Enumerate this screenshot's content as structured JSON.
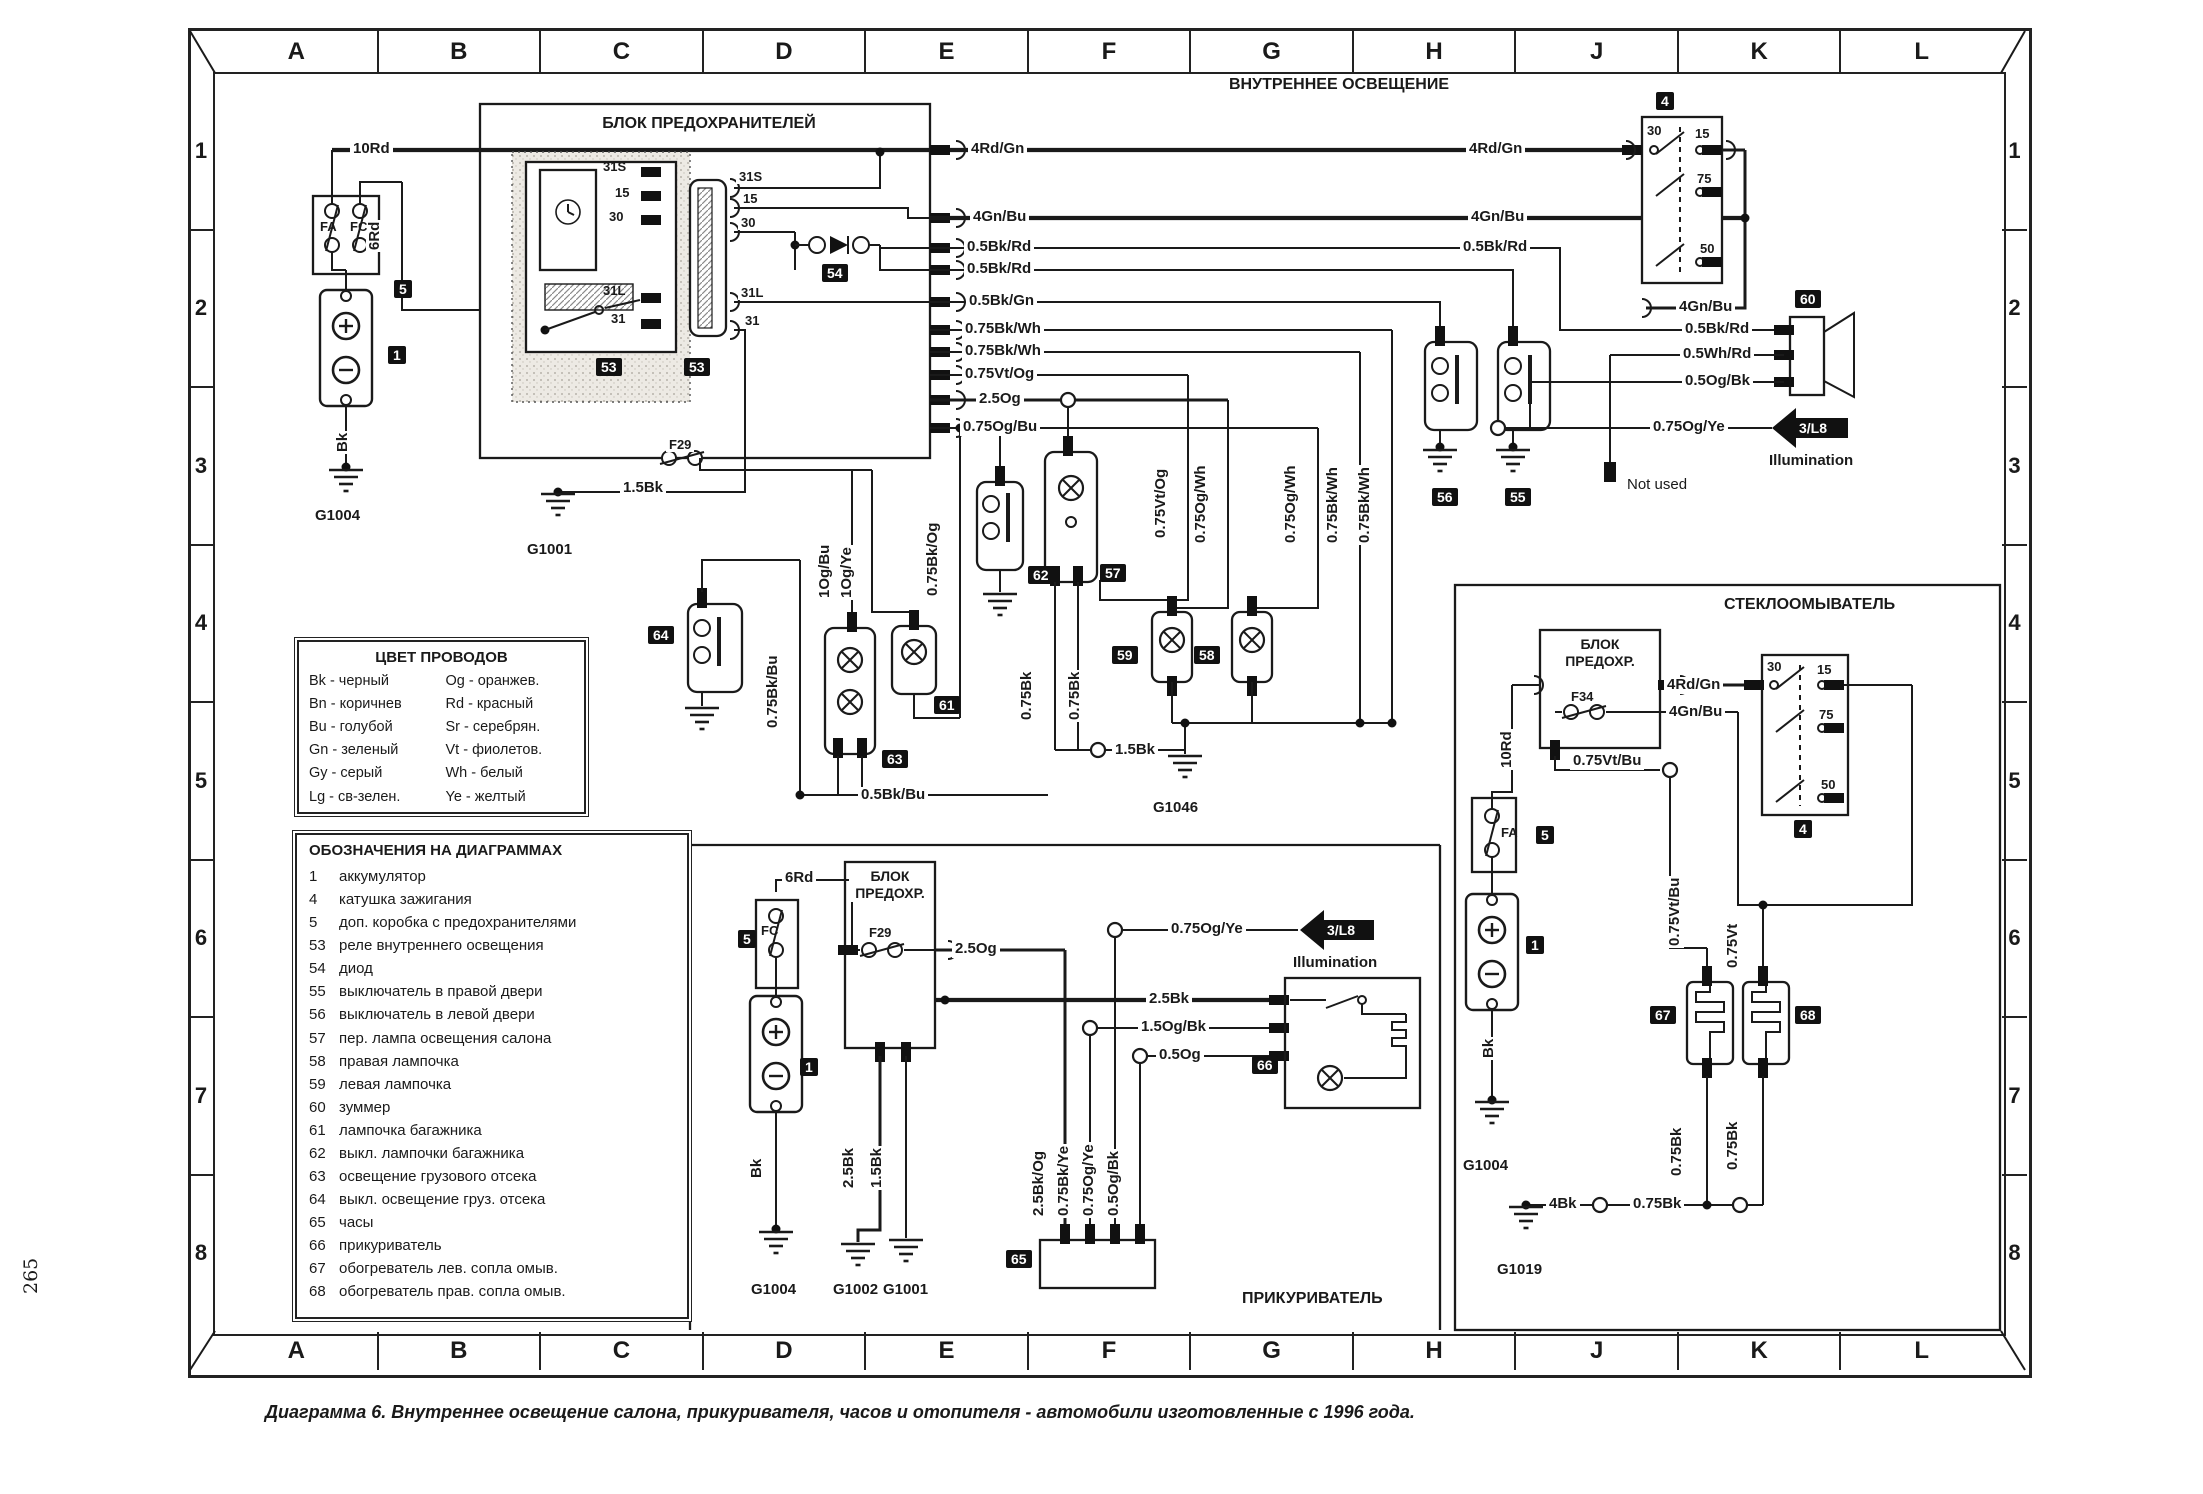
{
  "page": {
    "number": "265",
    "caption": "Диаграмма 6. Внутреннее освещение салона, прикуривателя, часов и отопителя - автомобили изготовленные с 1996 года."
  },
  "grid": {
    "columns": [
      "A",
      "B",
      "C",
      "D",
      "E",
      "F",
      "G",
      "H",
      "J",
      "K",
      "L"
    ],
    "rows": [
      "1",
      "2",
      "3",
      "4",
      "5",
      "6",
      "7",
      "8"
    ]
  },
  "ti": {
    "interior": "ВНУТРЕННЕЕ ОСВЕЩЕНИЕ",
    "washer": "СТЕКЛООМЫВАТЕЛЬ",
    "lighter": "ПРИКУРИВАТЕЛЬ",
    "fuse_main": "БЛОК ПРЕДОХРАНИТЕЛЕЙ",
    "fuse_s1": "БЛОК",
    "fuse_s2": "ПРЕДОХР."
  },
  "w": {
    "w10Rd": "10Rd",
    "w6Rd": "6Rd",
    "wBk": "Bk",
    "w15Bk": "1.5Bk",
    "w25Bk": "2.5Bk",
    "w4Bk": "4Bk",
    "w075Bk": "0.75Bk",
    "w4RdGn": "4Rd/Gn",
    "w4GnBu": "4Gn/Bu",
    "w05BkRd": "0.5Bk/Rd",
    "w05WhRd": "0.5Wh/Rd",
    "w05OgBk": "0.5Og/Bk",
    "w05BkGn": "0.5Bk/Gn",
    "w05Og": "0.5Og",
    "w05BkBu": "0.5Bk/Bu",
    "w075BkWh": "0.75Bk/Wh",
    "w075VtOg": "0.75Vt/Og",
    "w075OgBu": "0.75Og/Bu",
    "w075OgYe": "0.75Og/Ye",
    "w075OgWh": "0.75Og/Wh",
    "w075BkOg": "0.75Bk/Og",
    "w075BkBu": "0.75Bk/Bu",
    "w075BkYe": "0.75Bk/Ye",
    "w075VtBu": "0.75Vt/Bu",
    "w075Vt": "0.75Vt",
    "w1OgBu": "1Og/Bu",
    "w1OgYe": "1Og/Ye",
    "w25Og": "2.5Og",
    "w25BkOg": "2.5Bk/Og",
    "w15OgBk": "1.5Og/Bk"
  },
  "t": {
    "t30": "30",
    "t15": "15",
    "t75": "75",
    "t50": "50",
    "t31S": "31S",
    "t31L": "31L",
    "t31": "31"
  },
  "f": {
    "F29": "F29",
    "F34": "F34",
    "FA": "FA",
    "FC": "FC"
  },
  "g": {
    "G1001": "G1001",
    "G1002": "G1002",
    "G1004": "G1004",
    "G1019": "G1019",
    "G1046": "G1046"
  },
  "c": {
    "1": "1",
    "4": "4",
    "5": "5",
    "53": "53",
    "54": "54",
    "55": "55",
    "56": "56",
    "57": "57",
    "58": "58",
    "59": "59",
    "60": "60",
    "61": "61",
    "62": "62",
    "63": "63",
    "64": "64",
    "65": "65",
    "66": "66",
    "67": "67",
    "68": "68"
  },
  "m": {
    "not_used": "Not used",
    "illumination": "Illumination",
    "ref": "3/L8"
  },
  "color_legend": {
    "title": "ЦВЕТ ПРОВОДОВ",
    "left": [
      "Bk - черный",
      "Bn - коричнев",
      "Bu - голубой",
      "Gn - зеленый",
      "Gy - серый",
      "Lg - св-зелен."
    ],
    "right": [
      "Og - оранжев.",
      "Rd - красный",
      "Sr - серебрян.",
      "Vt - фиолетов.",
      "Wh - белый",
      "Ye - желтый"
    ]
  },
  "symbol_legend": {
    "title": "ОБОЗНАЧЕНИЯ НА ДИАГРАММАХ",
    "items": [
      {
        "n": "1",
        "l": "аккумулятор"
      },
      {
        "n": "4",
        "l": "катушка зажигания"
      },
      {
        "n": "5",
        "l": "доп. коробка с предохранителями"
      },
      {
        "n": "53",
        "l": "реле внутреннего освещения"
      },
      {
        "n": "54",
        "l": "диод"
      },
      {
        "n": "55",
        "l": "выключатель в правой двери"
      },
      {
        "n": "56",
        "l": "выключатель в левой двери"
      },
      {
        "n": "57",
        "l": "пер. лампа освещения салона"
      },
      {
        "n": "58",
        "l": "правая лампочка"
      },
      {
        "n": "59",
        "l": "левая лампочка"
      },
      {
        "n": "60",
        "l": "зуммер"
      },
      {
        "n": "61",
        "l": "лампочка багажника"
      },
      {
        "n": "62",
        "l": "выкл. лампочки багажника"
      },
      {
        "n": "63",
        "l": "освещение грузового отсека"
      },
      {
        "n": "64",
        "l": "выкл. освещение груз. отсека"
      },
      {
        "n": "65",
        "l": "часы"
      },
      {
        "n": "66",
        "l": "прикуриватель"
      },
      {
        "n": "67",
        "l": "обогреватель лев. сопла омыв."
      },
      {
        "n": "68",
        "l": "обогреватель прав. сопла омыв."
      }
    ]
  }
}
